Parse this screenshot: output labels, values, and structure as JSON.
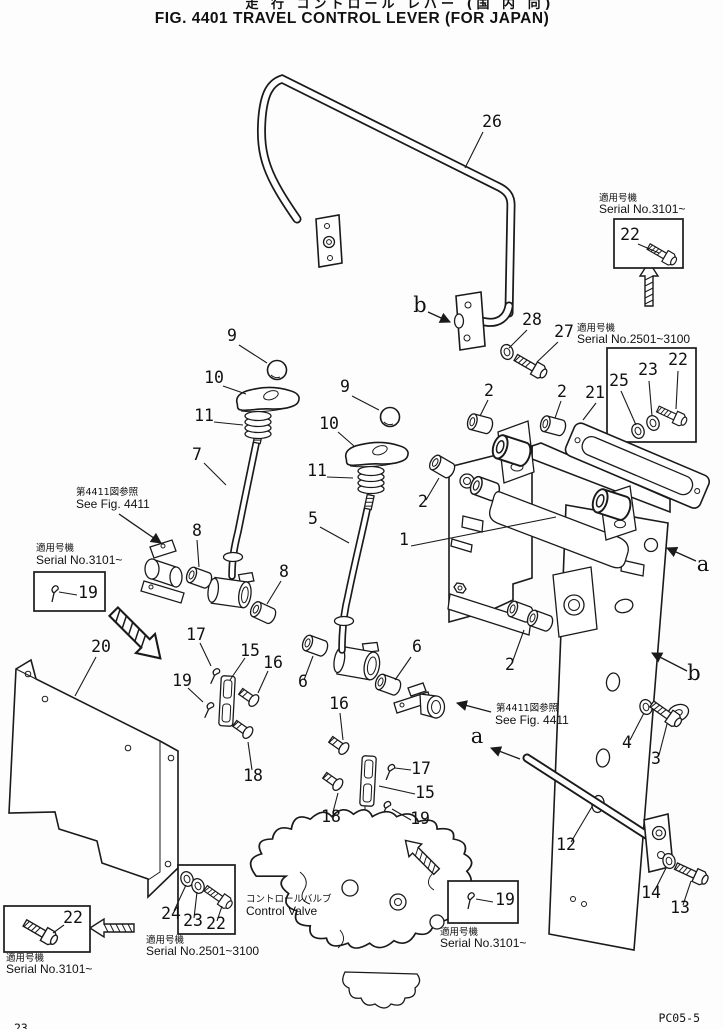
{
  "figure": {
    "title_jp": "走 行  コントロール レバー  (国 内 向)",
    "title_en": "FIG. 4401  TRAVEL CONTROL LEVER (FOR JAPAN)"
  },
  "annotations": {
    "applicable_jp": "適用号機",
    "serial_3101": "Serial No.3101~",
    "serial_2501_3100": "Serial No.2501~3100",
    "see_fig_jp": "第4411図参照",
    "see_fig_en": "See  Fig. 4411",
    "control_valve_jp": "コントロールバルブ",
    "control_valve_en": "Control  Valve"
  },
  "parts": {
    "n1": "1",
    "n2": "2",
    "n3": "3",
    "n4": "4",
    "n5": "5",
    "n6": "6",
    "n7": "7",
    "n8": "8",
    "n9": "9",
    "n10": "10",
    "n11": "11",
    "n12": "12",
    "n13": "13",
    "n14": "14",
    "n15": "15",
    "n16": "16",
    "n17": "17",
    "n18": "18",
    "n19": "19",
    "n20": "20",
    "n21": "21",
    "n22": "22",
    "n23": "23",
    "n24": "24",
    "n25": "25",
    "n26": "26",
    "n27": "27",
    "n28": "28"
  },
  "ref_letters": {
    "a": "a",
    "b": "b"
  },
  "footer": {
    "doc_code": "PC05-5",
    "page_no": "23"
  }
}
